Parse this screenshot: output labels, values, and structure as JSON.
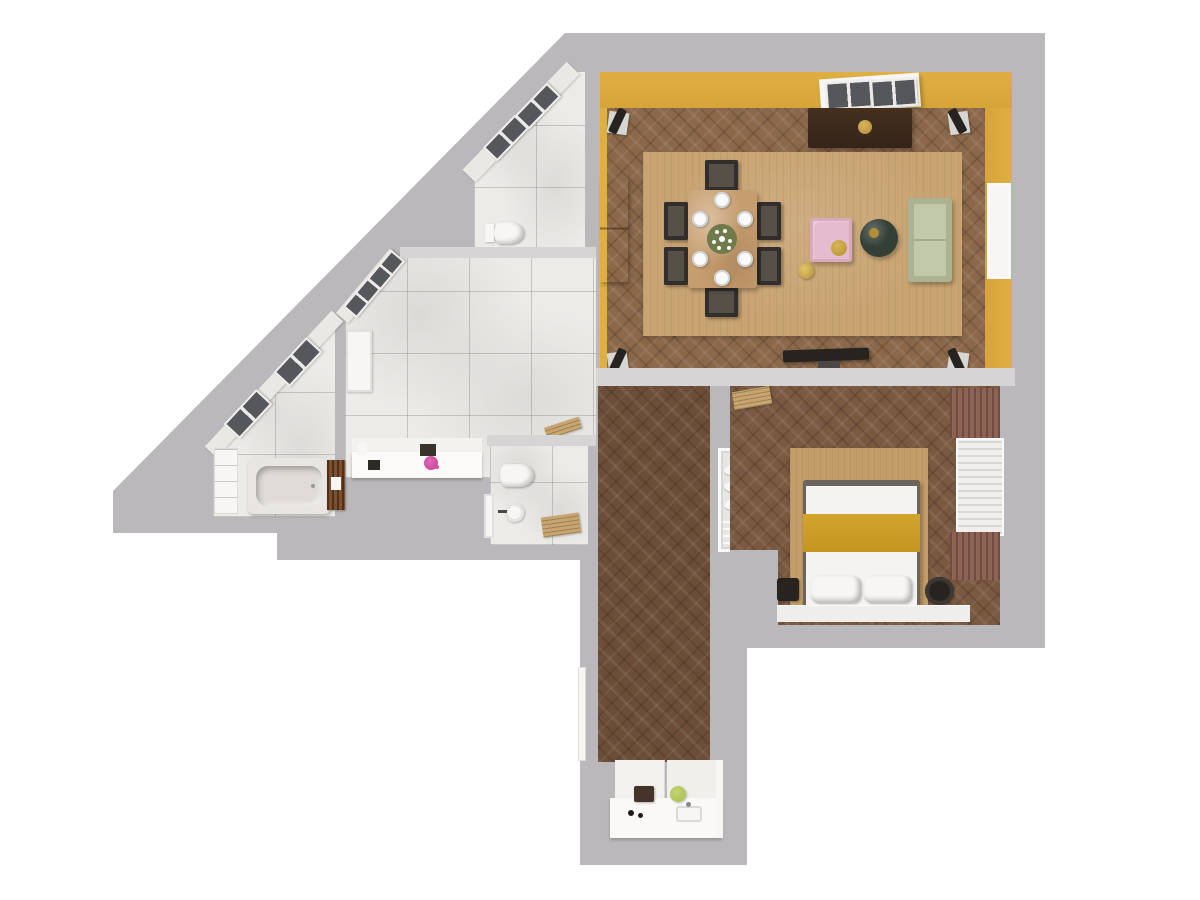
{
  "scene": {
    "type": "3D rendered apartment floor plan, top-down view",
    "background_color": "#ffffff",
    "text_content": "none (image contains no text)"
  },
  "palette": {
    "wall": "#bab8ba",
    "wallCap": "#d6d4d4",
    "yellow": "#e0af43",
    "woodLiving": "#8b684a",
    "woodBedroom": "#7a5941",
    "woodHall": "#6c4e38",
    "rug": "#c9a473",
    "rugBed": "#c49e68",
    "marble": "#edebe8",
    "tableWood": "#c69d6e",
    "chairDark": "#322e2b",
    "chairSeat": "#565049",
    "sideboard": "#45301f",
    "gold": "#b28e38",
    "sofa": "#abb392",
    "sofaSeat": "#c2c9ab",
    "pink": "#e5bccd",
    "coffeeTable": "#343f36",
    "orangeCabinet": "#bd6b3e",
    "fixtureWhite": "#f7f6f4",
    "skylight": "#55575a",
    "curtain": "#8e6255",
    "blanket": "#d2a62d",
    "dark": "#27241f",
    "counter": "#f3f1ee",
    "lime": "#a6bd4d",
    "board": "#43332a",
    "woodSlat": "#7d4f2e",
    "blinds": "#f0efed",
    "tan": "#c8a56e"
  },
  "rooms": [
    {
      "id": "living-dining-room",
      "wall_color": "#e0af43",
      "floor": "oak herringbone parquet",
      "items": [
        "roof-skylight",
        "dark-sideboard with gold medallion",
        "area-rug",
        "dining-table",
        "6 dining chairs",
        "6 place-setting plates",
        "white flower centerpiece",
        "pink armchair with gold cushion",
        "gold floor lamp",
        "round dark coffee table",
        "sage-green sofa",
        "terracotta cabinet",
        "4 corner speakers",
        "window",
        "tv on stand"
      ]
    },
    {
      "id": "wc-top",
      "floor": "white marble tile",
      "items": [
        "wall-hung toilet",
        "2 sloped roof windows"
      ]
    },
    {
      "id": "main-bathroom",
      "floor": "white marble tile",
      "items": [
        "vanity counter",
        "soap tray",
        "pink flowers",
        "2 sloped roof windows",
        "white door",
        "corner shelf"
      ]
    },
    {
      "id": "bathtub-room",
      "floor": "white marble tile",
      "items": [
        "marble bathtub",
        "wooden towel ladder",
        "white wardrobe panels",
        "2 sloped roof windows"
      ]
    },
    {
      "id": "wc-small",
      "floor": "white marble tile",
      "items": [
        "toilet",
        "round washbasin",
        "wooden bath mat",
        "white door"
      ]
    },
    {
      "id": "hallway",
      "floor": "dark herringbone parquet",
      "items": [
        "linen closet with towels",
        "entry door"
      ]
    },
    {
      "id": "kitchen",
      "items": [
        "white counter",
        "cutting board",
        "lime fruit bowl",
        "hob knobs",
        "sink"
      ]
    },
    {
      "id": "bedroom",
      "floor": "walnut herringbone parquet",
      "items": [
        "double bed",
        "2 pillows",
        "mustard throw blanket",
        "bedside rug",
        "2 nightstands",
        "window with blinds",
        "2 brown curtains",
        "luggage rack",
        "window sill bench"
      ]
    }
  ]
}
